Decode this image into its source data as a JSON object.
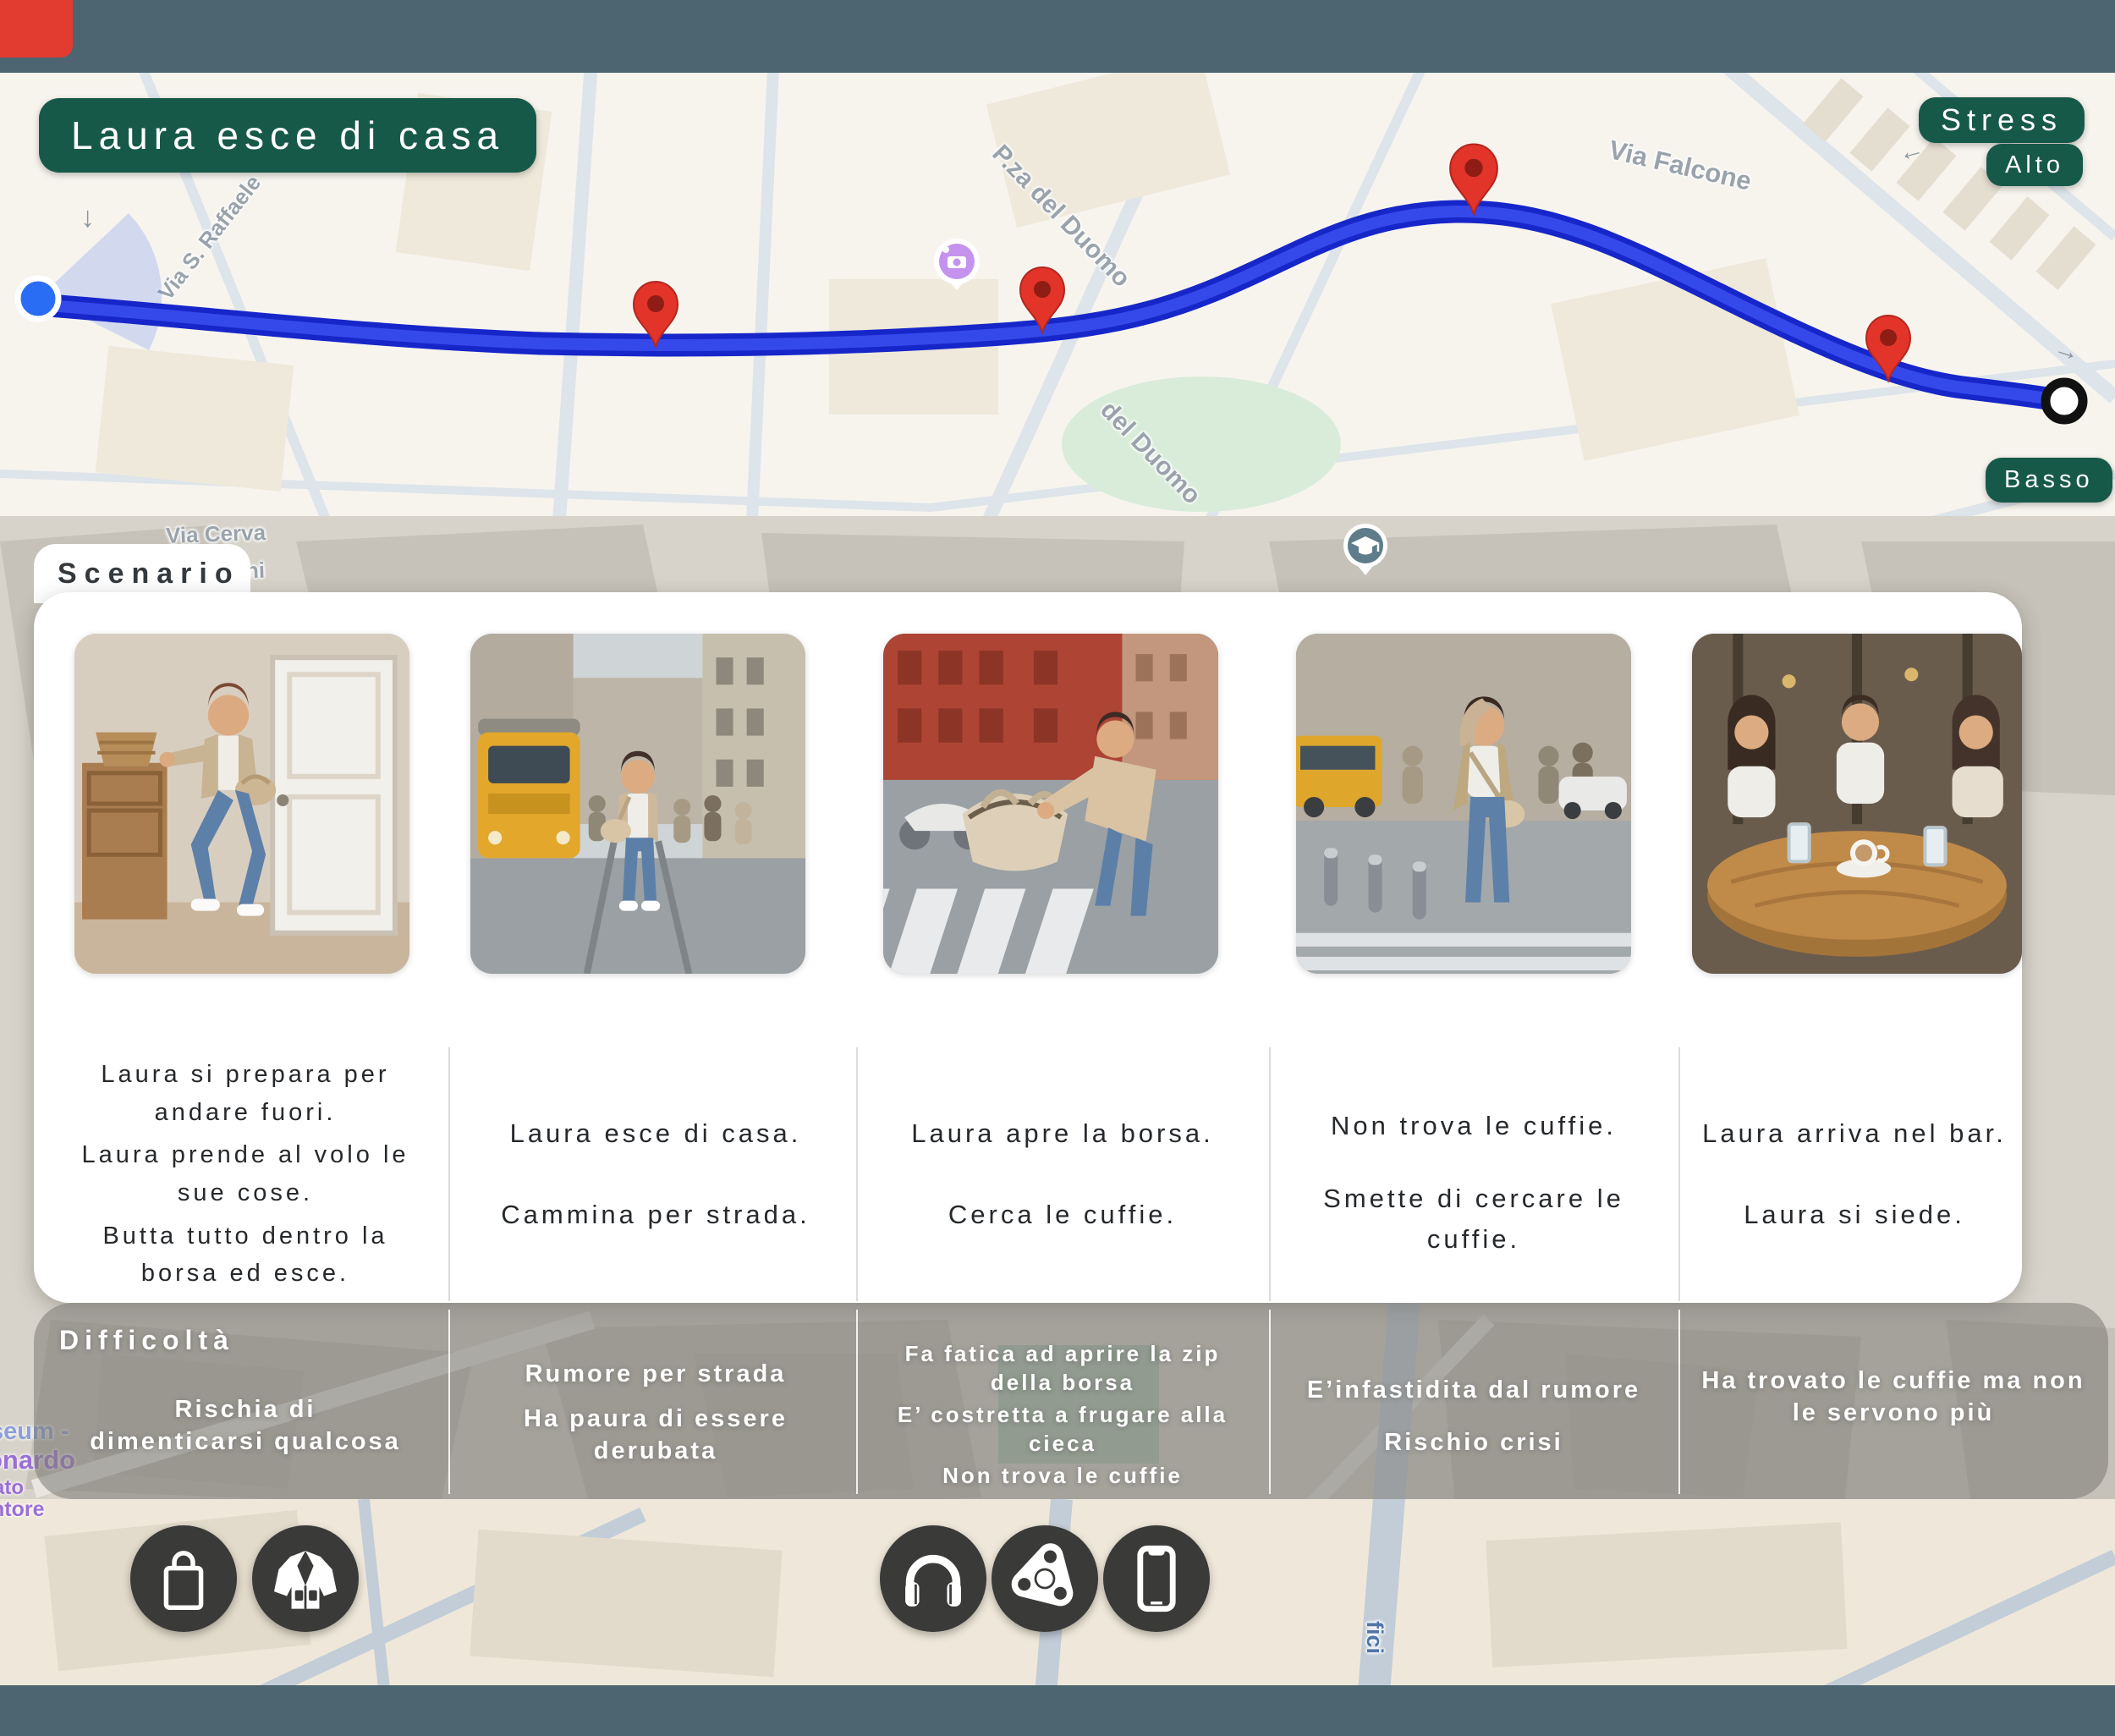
{
  "colors": {
    "chrome_bar": "#4d6570",
    "badge_green": "#175949",
    "route_blue_outer": "#1626c9",
    "route_blue_inner": "#3549ea",
    "pin_red": "#e3342a",
    "card_white": "#ffffff",
    "difficulty_overlay_gray": "#807d78",
    "icon_circle_dark": "#3a3a38",
    "map_label_gray": "#9aa3ab",
    "poi_label_purple": "#9b6fd4",
    "corner_red": "#e23c30"
  },
  "header": {
    "title_badge": "Laura esce di casa",
    "stress_label": "Stress",
    "stress_level_high": "Alto",
    "stress_level_low": "Basso"
  },
  "map": {
    "labels": {
      "raffaele": "Via S. Raffaele",
      "piazza_duomo": "P.za del Duomo",
      "del_duomo": "del Duomo",
      "falcone": "Via Falcone",
      "cerva": "Via Cerva",
      "durini": "Durini",
      "fici": "fici",
      "poi_cut_1": "seum -",
      "poi_cut_2": "onardo",
      "poi_cut_3": "ato",
      "poi_cut_4": "ntore"
    },
    "arrows": {
      "a1": "↓",
      "a2": "←",
      "a3": "→"
    }
  },
  "scenario": {
    "title": "Scenario",
    "steps": [
      {
        "image": "laura-prepares-at-home-photo",
        "captions": [
          "Laura si prepara per andare fuori.",
          "Laura prende al volo le sue cose.",
          "Butta tutto dentro la borsa ed esce."
        ]
      },
      {
        "image": "street-with-tram-photo",
        "captions": [
          "Laura esce di casa.",
          "Cammina per strada."
        ]
      },
      {
        "image": "opens-handbag-crosswalk-photo",
        "captions": [
          "Laura apre la borsa.",
          "Cerca le cuffie."
        ]
      },
      {
        "image": "hand-on-head-street-photo",
        "captions": [
          "Non trova le cuffie.",
          "Smette di cercare le cuffie."
        ]
      },
      {
        "image": "cafe-table-friends-photo",
        "captions": [
          "Laura arriva nel bar.",
          "Laura si siede."
        ]
      }
    ]
  },
  "difficulty": {
    "title": "Difficoltà",
    "columns": [
      [
        "Rischia di dimenticarsi qualcosa"
      ],
      [
        "Rumore per strada",
        "Ha paura di essere derubata"
      ],
      [
        "Fa fatica ad aprire la zip della borsa",
        "E’ costretta a frugare alla cieca",
        "Non trova le cuffie"
      ],
      [
        "E’infastidita dal rumore",
        "Rischio crisi"
      ],
      [
        "Ha trovato le cuffie ma non le servono più"
      ]
    ]
  },
  "items": {
    "left": [
      "bag-icon",
      "jacket-icon"
    ],
    "center": [
      "headphones-icon",
      "fidget-spinner-icon",
      "smartphone-icon"
    ]
  }
}
